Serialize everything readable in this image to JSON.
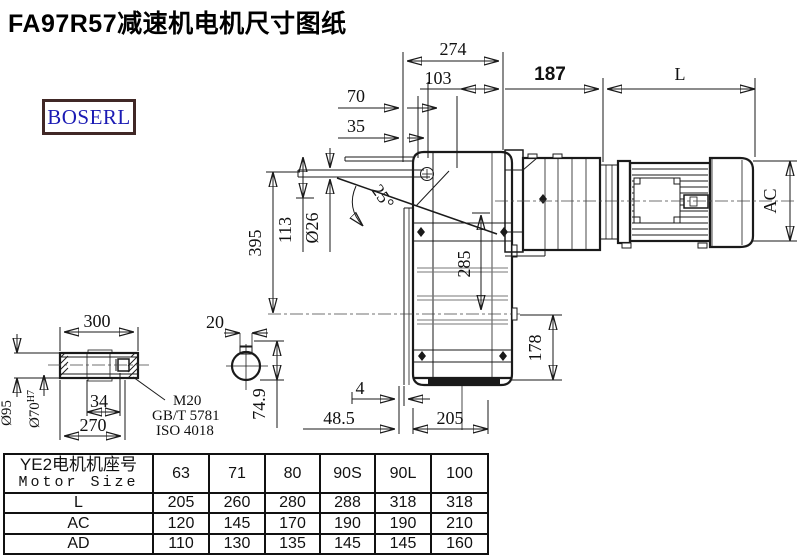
{
  "page": {
    "title": "FA97R57减速机电机尺寸图纸",
    "logo": "BOSERL"
  },
  "colors": {
    "logo_text": "#1b1bb4",
    "logo_border": "#402826",
    "line": "#1a1a1a"
  },
  "dims": {
    "d274": "274",
    "d103": "103",
    "d70": "70",
    "d35": "35",
    "d187": "187",
    "dL": "L",
    "dAC": "AC",
    "d395": "395",
    "d113": "113",
    "d26": "Ø26",
    "d25": "25°",
    "d285": "285",
    "d178": "178",
    "d4": "4",
    "d48_5": "48.5",
    "d205": "205",
    "d300": "300",
    "d95": "Ø95",
    "d70bore": "Ø70",
    "d70tol": "H7",
    "d34": "34",
    "d270": "270",
    "m20": "M20",
    "gbt": "GB/T 5781",
    "iso": "ISO 4018",
    "d20": "20",
    "d74_9": "74.9"
  },
  "table": {
    "header_cn": "YE2电机机座号",
    "header_en": "Motor Size",
    "columns": [
      "63",
      "71",
      "80",
      "90S",
      "90L",
      "100"
    ],
    "rows": [
      {
        "label": "L",
        "values": [
          "205",
          "260",
          "280",
          "288",
          "318",
          "318"
        ]
      },
      {
        "label": "AC",
        "values": [
          "120",
          "145",
          "170",
          "190",
          "190",
          "210"
        ]
      },
      {
        "label": "AD",
        "values": [
          "110",
          "130",
          "135",
          "145",
          "145",
          "160"
        ]
      }
    ]
  }
}
